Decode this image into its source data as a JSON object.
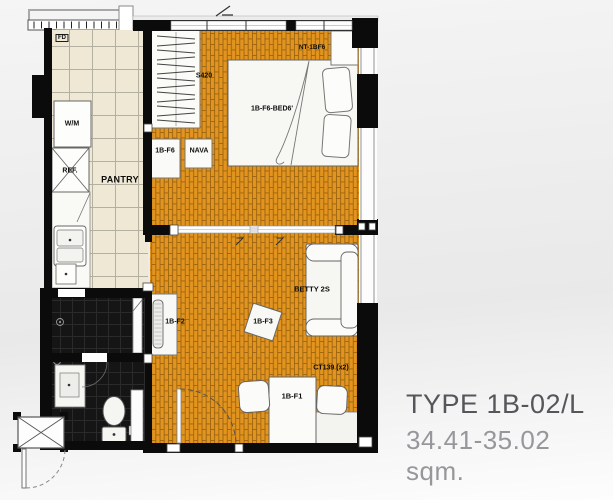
{
  "plan": {
    "labels": {
      "floor_drain": "FD",
      "washing_machine": "W/M",
      "refrigerator": "REF.",
      "pantry": "PANTRY",
      "wardrobe_code": "S420",
      "cabinet_code": "1B-F6",
      "nava_code": "NAVA",
      "nightstand_code": "NT-1BF6",
      "bed_code": "1B-F6-BED6'",
      "tv_console_code": "1B-F2",
      "coffee_table_code": "1B-F3",
      "sofa_code": "BETTY 2S",
      "curtain_code": "CT139 (x2)",
      "dining_table_code": "1B-F1"
    },
    "colors": {
      "brick_floor": "#e2941f",
      "brick_grout": "#996310",
      "tile_floor": "#efe8d4",
      "tile_grout": "#b3afa1",
      "bath_floor": "#151515",
      "wall": "#0b0b0b",
      "furniture": "#f6f6f3"
    }
  },
  "title_block": {
    "type_label": "TYPE 1B-02/L",
    "area_label": "34.41-35.02 sqm.",
    "type_color": "#54565a",
    "area_color": "#95979a"
  }
}
